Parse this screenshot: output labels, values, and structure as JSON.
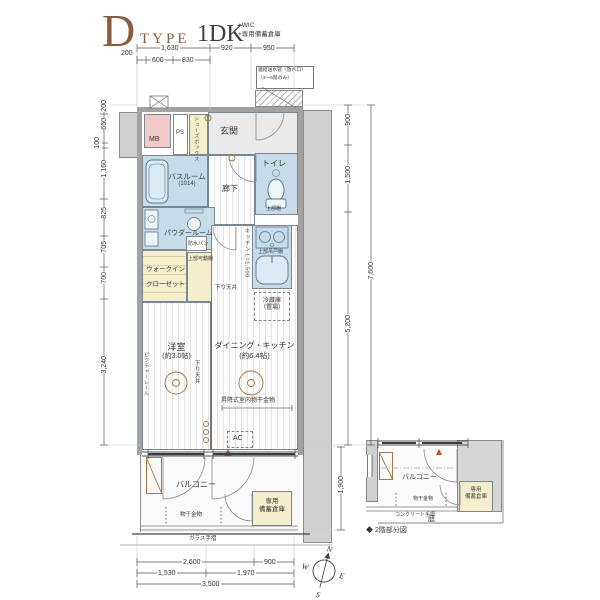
{
  "header": {
    "type_letter": "D",
    "type_word": "TYPE",
    "plan_type": "1DK",
    "plan_extra1": "+WIC",
    "plan_extra2": "+専用備蓄倉庫"
  },
  "note": {
    "line1": "連結送水管（放水口）",
    "line2": "（3〜5階のみ）"
  },
  "dims": {
    "top1": [
      "1,630",
      "920",
      "950"
    ],
    "top2": [
      "200",
      "600",
      "830"
    ],
    "left": [
      "200",
      "650",
      "100",
      "1,160",
      "825",
      "705",
      "700",
      "3,240"
    ],
    "right": [
      "900",
      "1,500",
      "5,200"
    ],
    "right_total": "7,600",
    "balcony_depth": "1,900",
    "bottom1": [
      "2,600",
      "900"
    ],
    "bottom2": [
      "1,530",
      "1,970"
    ],
    "bottom_total": "3,500"
  },
  "plan": {
    "mb": "MB",
    "ps": "PS",
    "shoes": "シューズボックス",
    "entrance": "玄関",
    "corridor": "廊下",
    "toilet": "トイレ",
    "toilet_shelf": "上部棚",
    "bath": "バスルーム",
    "bath_size": "(1014)",
    "powder": "パウダールーム",
    "pan": "防水パン",
    "shelf": "上部可動棚",
    "wic1": "ウォークイン",
    "wic2": "クローゼット",
    "kitchen": "キッチン L=1,500",
    "cupboard": "上部吊戸棚",
    "fridge1": "冷蔵庫",
    "fridge2": "（置場）",
    "down_ceil": "下り天井",
    "pict_rail": "ピクチャーレール",
    "west": "洋室",
    "west_size": "(約3.0帖)",
    "dk": "ダイニング・キッチン",
    "dk_size": "(約6.4帖)",
    "dry_unit": "昇降式室内物干金物",
    "ac": "AC",
    "balcony": "バルコニー",
    "dry_hw": "物干金物",
    "glass_rail": "ガラス手摺",
    "store1": "専用",
    "store2": "備蓄倉庫"
  },
  "sub": {
    "balcony": "バルコニー",
    "dry_hw": "物干金物",
    "store1": "専用",
    "store2": "備蓄倉庫",
    "concrete_rail": "コンクリート手摺",
    "garden": "庭",
    "caption": "◆ 2階部分図"
  },
  "compass": {
    "n": "N",
    "e": "E",
    "s": "S",
    "w": "W"
  },
  "colors": {
    "accent_brown": "#8a5c3e",
    "wet_blue": "#c6dce9",
    "closet_cream": "#f4eecd",
    "mb_pink": "#f1c9c7",
    "wall_gray": "#a2a2a2",
    "hatch_brown": "#a9743f",
    "marker_orange": "#c3531f"
  }
}
